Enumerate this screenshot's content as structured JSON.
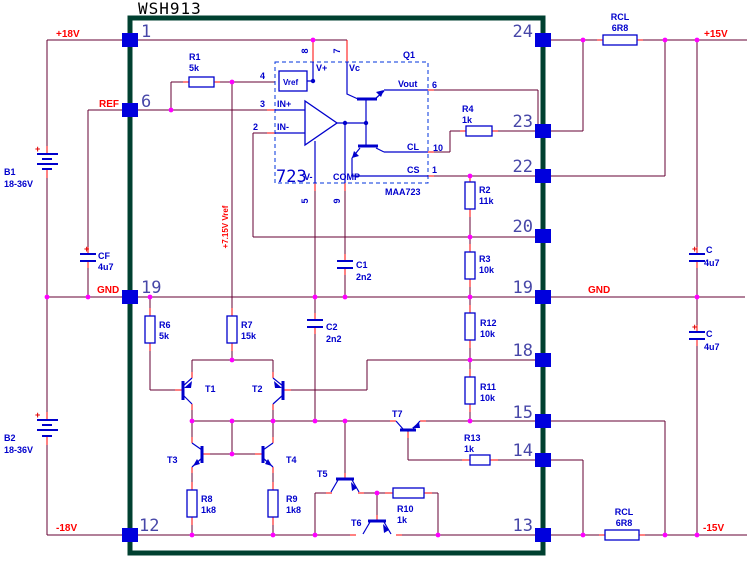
{
  "title": "WSH913",
  "sym_plus": "+",
  "rails": {
    "p18v": "+18V",
    "ref": "REF",
    "gnd_l": "GND",
    "m18v": "-18V",
    "p15v": "+15V",
    "gnd_r": "GND",
    "m15v": "-15V",
    "vref_note": "+7.15V Vref"
  },
  "pins": {
    "left": [
      "1",
      "6",
      "19",
      "12"
    ],
    "right": [
      "24",
      "23",
      "22",
      "20",
      "19",
      "18",
      "15",
      "14",
      "13"
    ]
  },
  "ic": {
    "big": "723",
    "part": "MAA723",
    "q1": "Q1",
    "vref_box": "Vref",
    "vplus": "V+",
    "vc": "Vc",
    "in_p": "IN+",
    "in_m": "IN-",
    "v_m": "V-",
    "comp": "COMP",
    "vout": "Vout",
    "cl": "CL",
    "cs": "CS",
    "n": {
      "p4": "4",
      "p3": "3",
      "p2": "2",
      "p8": "8",
      "p7": "7",
      "p6": "6",
      "p10": "10",
      "p1": "1",
      "p5": "5",
      "p9": "9"
    }
  },
  "parts": {
    "r1": {
      "n": "R1",
      "v": "5k"
    },
    "r2": {
      "n": "R2",
      "v": "11k"
    },
    "r3": {
      "n": "R3",
      "v": "10k"
    },
    "r4": {
      "n": "R4",
      "v": "1k"
    },
    "r6": {
      "n": "R6",
      "v": "5k"
    },
    "r7": {
      "n": "R7",
      "v": "15k"
    },
    "r8": {
      "n": "R8",
      "v": "1k8"
    },
    "r9": {
      "n": "R9",
      "v": "1k8"
    },
    "r10": {
      "n": "R10",
      "v": "1k"
    },
    "r11": {
      "n": "R11",
      "v": "10k"
    },
    "r12": {
      "n": "R12",
      "v": "10k"
    },
    "r13": {
      "n": "R13",
      "v": "1k"
    },
    "rcl_top": {
      "n": "RCL",
      "v": "6R8"
    },
    "rcl_bot": {
      "n": "RCL",
      "v": "6R8"
    },
    "c1": {
      "n": "C1",
      "v": "2n2"
    },
    "c2": {
      "n": "C2",
      "v": "2n2"
    },
    "cf": {
      "n": "CF",
      "v": "4u7"
    },
    "c_top": {
      "n": "C",
      "v": "4u7"
    },
    "c_bot": {
      "n": "C",
      "v": "4u7"
    },
    "b1": {
      "n": "B1",
      "v": "18-36V"
    },
    "b2": {
      "n": "B2",
      "v": "18-36V"
    },
    "t1": "T1",
    "t2": "T2",
    "t3": "T3",
    "t4": "T4",
    "t5": "T5",
    "t6": "T6",
    "t7": "T7"
  }
}
